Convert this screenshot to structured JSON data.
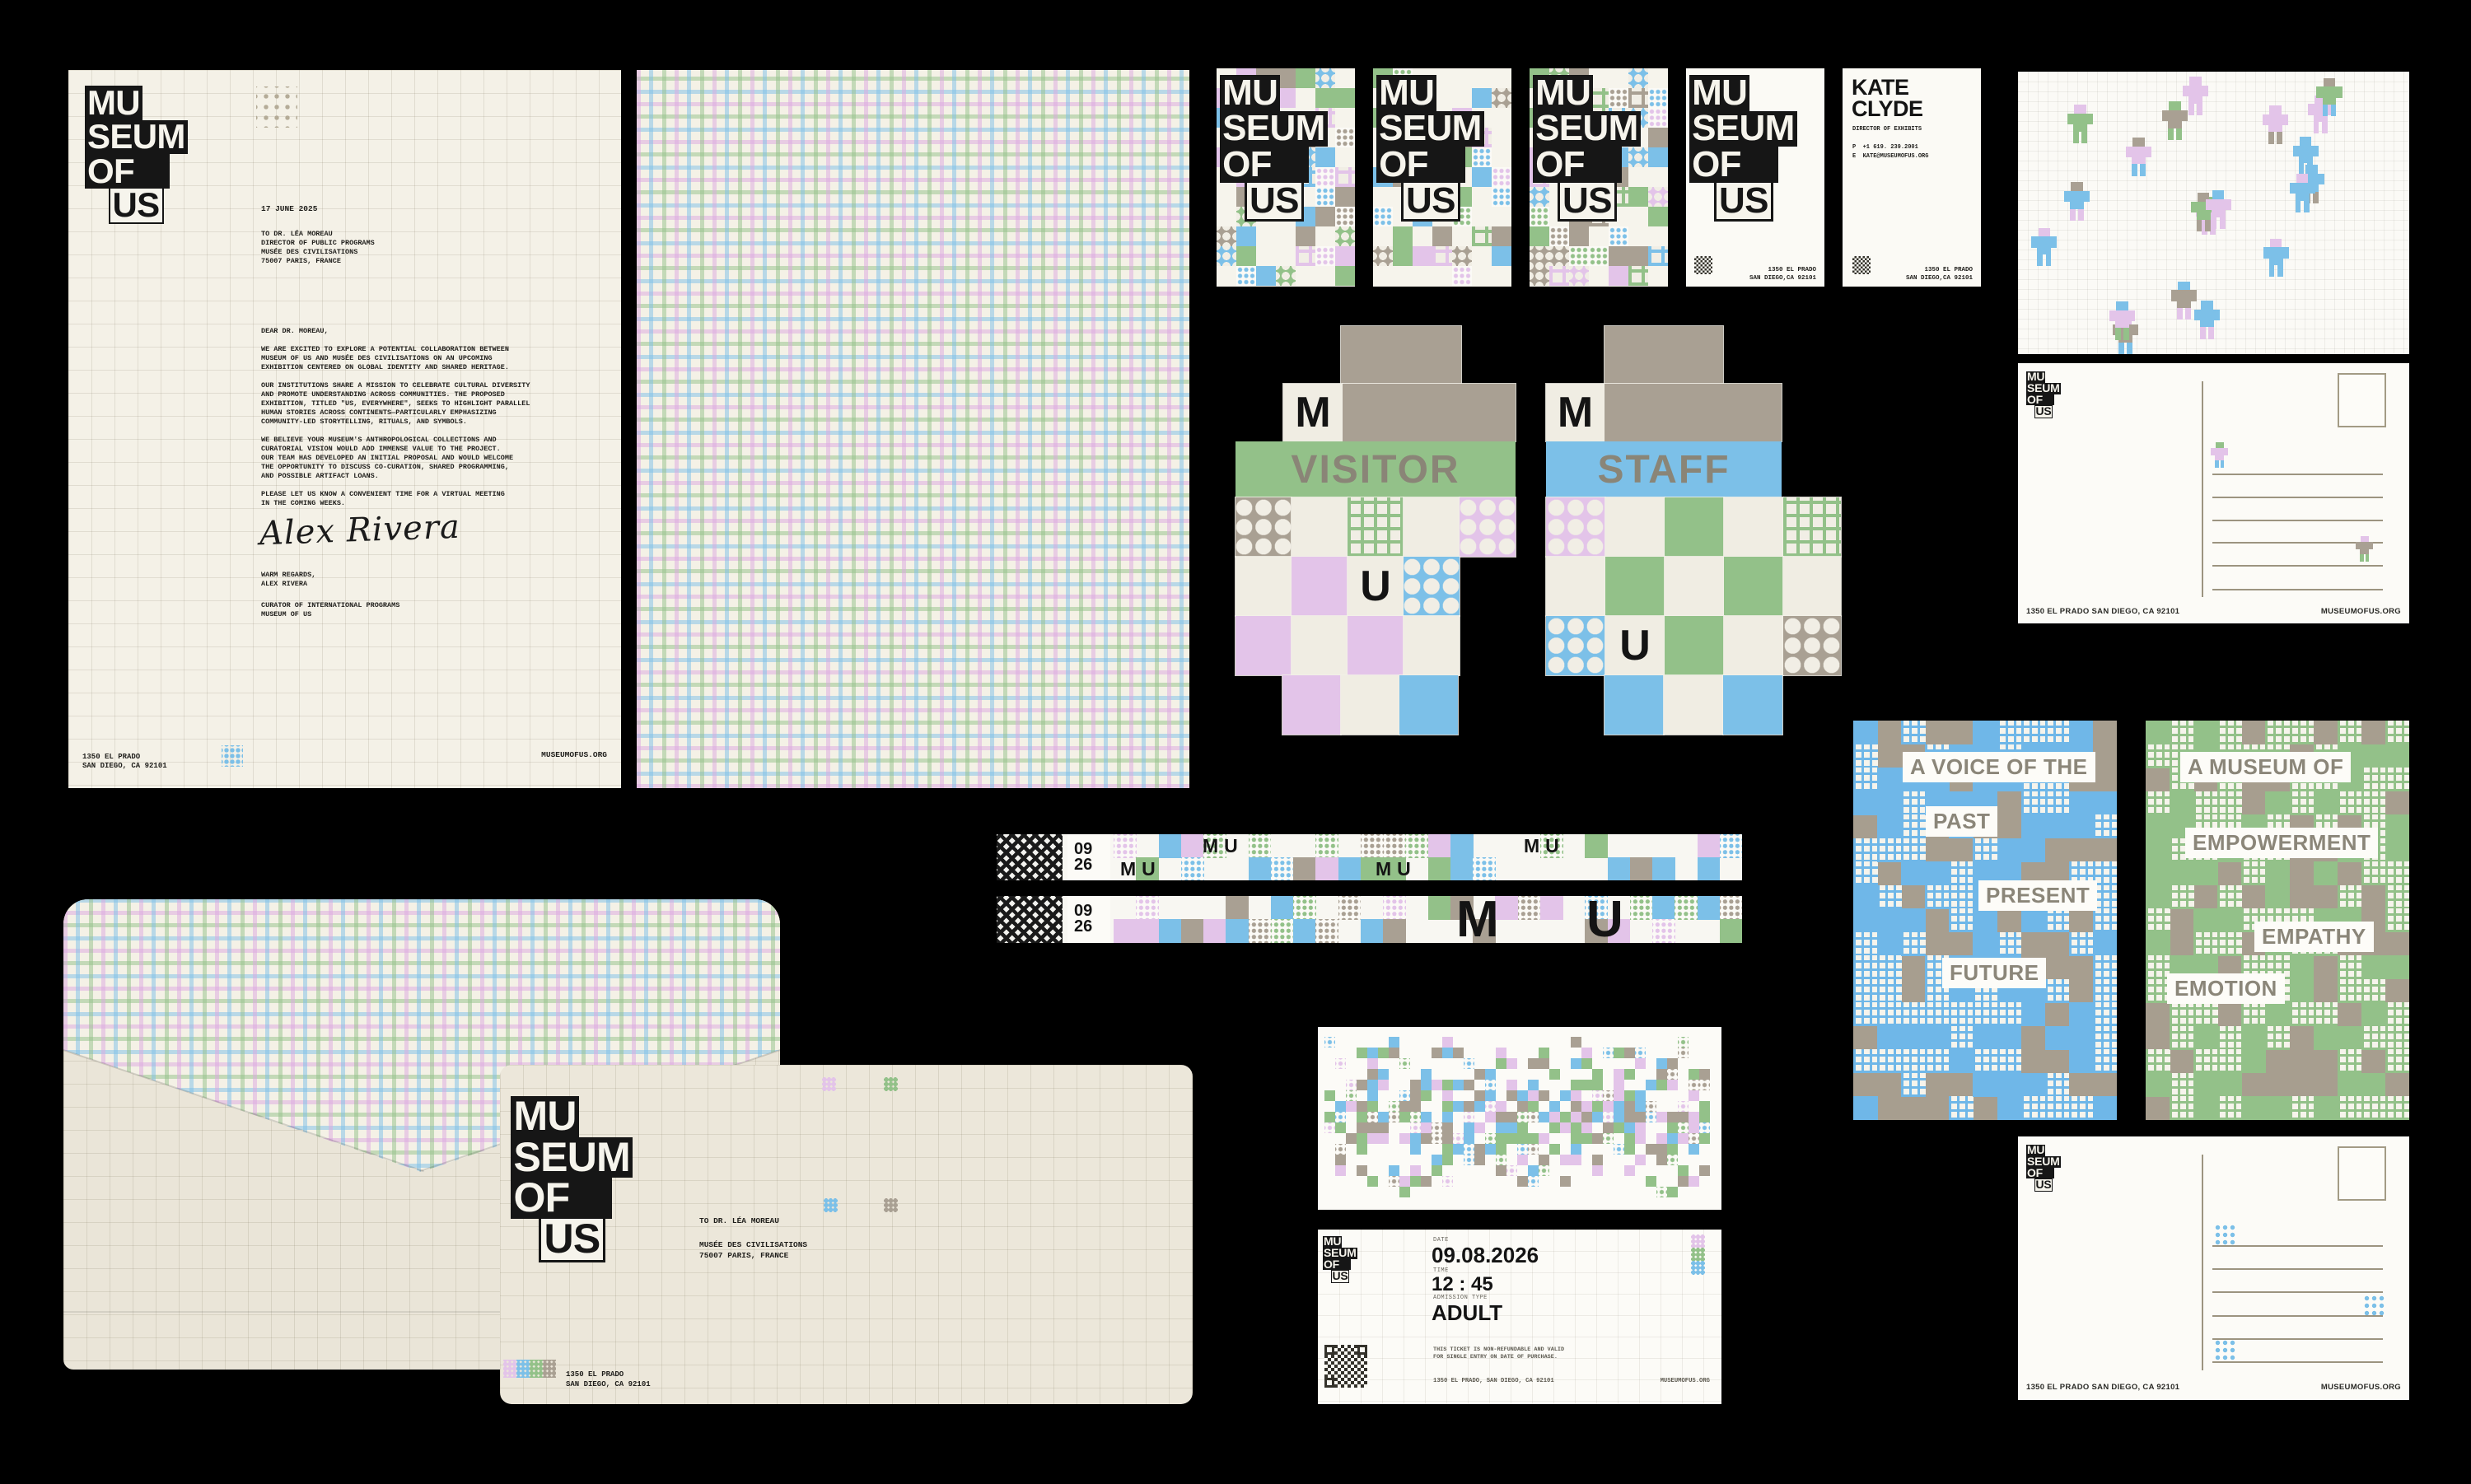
{
  "colors": {
    "pink": "#e3c4e9",
    "blue": "#7cc0e8",
    "green": "#93c189",
    "taupe": "#a9a093",
    "paper": "#f0ede3",
    "ink": "#161616",
    "band_text": "#8a8577"
  },
  "brand": {
    "logo": [
      "MU",
      "SEUM",
      "OF",
      "US"
    ],
    "website": "MUSEUMOFUS.ORG",
    "address_short": "1350 EL PRADO",
    "city": "SAN DIEGO, CA 92101",
    "address_card_city": "SAN DIEGO,CA 92101",
    "address_inline": "1350 EL PRADO SAN DIEGO, CA 92101",
    "address_ticket": "1350 EL PRADO, SAN DIEGO, CA 92101"
  },
  "letterhead": {
    "date": "17 JUNE 2025",
    "recipient": "TO DR. LÉA MOREAU\nDIRECTOR OF PUBLIC PROGRAMS\nMUSÉE DES CIVILISATIONS\n75007 PARIS, FRANCE",
    "salutation": "DEAR DR. MOREAU,",
    "paragraphs": [
      "WE ARE EXCITED TO EXPLORE A POTENTIAL COLLABORATION BETWEEN\nMUSEUM OF US AND MUSÉE DES CIVILISATIONS ON AN UPCOMING\nEXHIBITION CENTERED ON GLOBAL IDENTITY AND SHARED HERITAGE.",
      "OUR INSTITUTIONS SHARE A MISSION TO CELEBRATE CULTURAL DIVERSITY\nAND PROMOTE UNDERSTANDING ACROSS COMMUNITIES. THE PROPOSED\nEXHIBITION, TITLED \"US, EVERYWHERE\", SEEKS TO HIGHLIGHT PARALLEL\nHUMAN STORIES ACROSS CONTINENTS—PARTICULARLY EMPHASIZING\nCOMMUNITY-LED STORYTELLING, RITUALS, AND SYMBOLS.",
      "WE BELIEVE YOUR MUSEUM'S ANTHROPOLOGICAL COLLECTIONS AND\nCURATORIAL VISION WOULD ADD IMMENSE VALUE TO THE PROJECT.\nOUR TEAM HAS DEVELOPED AN INITIAL PROPOSAL AND WOULD WELCOME\nTHE OPPORTUNITY TO DISCUSS CO-CURATION, SHARED PROGRAMMING,\nAND POSSIBLE ARTIFACT LOANS.",
      "PLEASE LET US KNOW A CONVENIENT TIME FOR A VIRTUAL MEETING\nIN THE COMING WEEKS."
    ],
    "signature": "Alex Rivera",
    "signoff": "WARM REGARDS,\nALEX RIVERA",
    "sender_title": "CURATOR OF INTERNATIONAL PROGRAMS\nMUSEUM OF US"
  },
  "business_card": {
    "name_line1": "KATE",
    "name_line2": "CLYDE",
    "role": "DIRECTOR OF EXHIBITS",
    "phone_label": "P",
    "phone": "+1 619. 239.2001",
    "email_label": "E",
    "email": "KATE@MUSEUMOFUS.ORG"
  },
  "badges": {
    "m": "M",
    "u": "U",
    "visitor": "VISITOR",
    "staff": "STAFF"
  },
  "wristband": {
    "month": "09",
    "day": "26",
    "m": "M",
    "u": "U"
  },
  "posters": [
    {
      "lines": [
        "A VOICE OF THE",
        "PAST",
        "PRESENT",
        "FUTURE"
      ]
    },
    {
      "lines": [
        "A MUSEUM OF",
        "EMPOWERMENT",
        "EMPATHY",
        "EMOTION"
      ]
    }
  ],
  "envelope": {
    "to_name": "TO DR. LÉA MOREAU",
    "to_org": "MUSÉE DES CIVILISATIONS\n75007 PARIS, FRANCE"
  },
  "ticket": {
    "date_label": "DATE",
    "date": "09.08.2026",
    "time_label": "TIME",
    "time": "12 : 45",
    "type_label": "ADMISSION TYPE",
    "type": "ADULT",
    "disclaimer": "THIS TICKET IS NON-REFUNDABLE AND VALID\nFOR SINGLE ENTRY ON DATE OF PURCHASE."
  }
}
